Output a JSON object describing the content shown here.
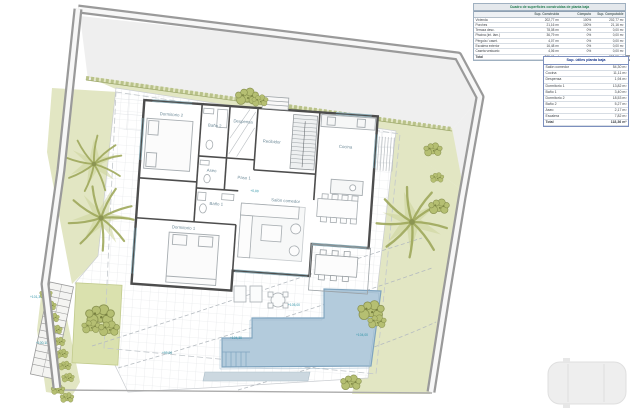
{
  "tables": {
    "construidas": {
      "title": "Cuadro de superficies construidas de planta baja",
      "header": [
        [
          "",
          "Sup. Construida",
          "Cómputo",
          "Sup. Computable"
        ]
      ],
      "rows": [
        [
          "Vivienda",
          "202,77 m²",
          "100%",
          "202,77 m²"
        ],
        [
          "Porches",
          "21,16 m²",
          "100%",
          "21,16 m²"
        ],
        [
          "Terraza desc.",
          "78,08 m²",
          "0%",
          "0,00 m²"
        ],
        [
          "Piscina (int. lám.)",
          "36,79 m²",
          "0%",
          "0,00 m²"
        ],
        [
          "Pérgola / caset.",
          "4,07 m²",
          "0%",
          "0,00 m²"
        ],
        [
          "Escalera exterior",
          "16,48 m²",
          "0%",
          "0,00 m²"
        ],
        [
          "Caseta vestuario",
          "4,06 m²",
          "0%",
          "0,00 m²"
        ],
        [
          "Total",
          "363,41 m²",
          "",
          "223,93 m²"
        ]
      ]
    },
    "utiles": {
      "title": "Sup. útiles planta baja",
      "rows": [
        [
          "Salón comedor",
          "54,30 m²"
        ],
        [
          "Cocina",
          "11,11 m²"
        ],
        [
          "Despensa",
          "1,94 m²"
        ],
        [
          "Dormitorio 1",
          "13,82 m²"
        ],
        [
          "Baño 1",
          "3,40 m²"
        ],
        [
          "Dormitorio 2",
          "18,53 m²"
        ],
        [
          "Baño 2",
          "5,27 m²"
        ],
        [
          "Aseo",
          "2,17 m²"
        ],
        [
          "Escalera",
          "7,82 m²"
        ],
        [
          "Total",
          "118,36 m²"
        ]
      ]
    }
  },
  "plan": {
    "rooms": {
      "dorm2": "Dormitorio 2",
      "bano2": "Baño 2",
      "despensa": "Despensa",
      "aseo": "Aseo",
      "paso": "Paso 1",
      "recibidor": "Recibidor",
      "cocina": "Cocina",
      "salon": "Salón comedor",
      "dorm1": "Dormitorio 1",
      "bano1": "Baño 1"
    },
    "levels": {
      "salon": "+0,00",
      "pool_a": "+105,00",
      "pool_b": "+104,30",
      "pool_c": "+104,00",
      "terrace": "+99,90",
      "stair_a": "+101,30",
      "stair_b": "+100,10"
    }
  },
  "colors": {
    "wall": "#9a9a9a",
    "garden": "#e2e6c3",
    "lawn": "#dae1ae",
    "pool": "#b3cbdc",
    "pool_edge": "#7fa4bf",
    "house_wall": "#4d4d4d",
    "level_text": "#2e93a6"
  }
}
